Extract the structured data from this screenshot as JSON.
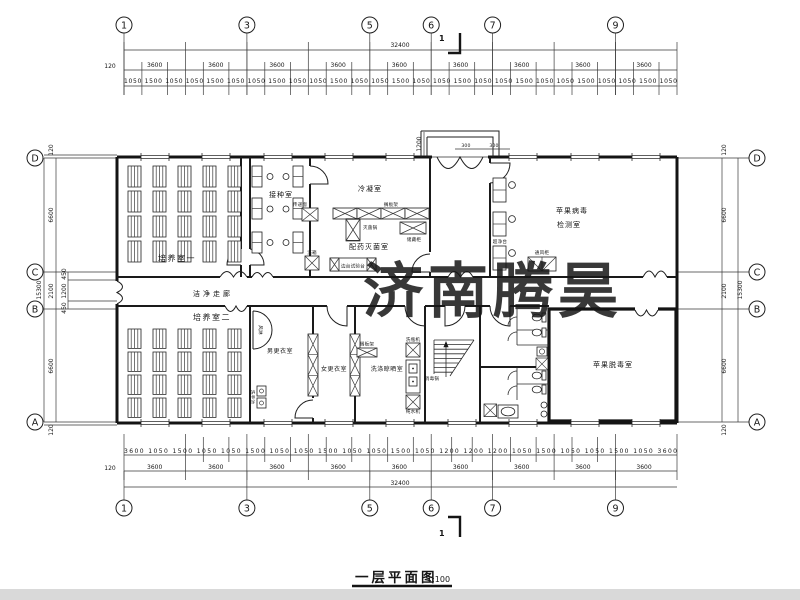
{
  "watermark": {
    "text": "济南腾昊"
  },
  "title": {
    "text": "一层平面图",
    "scale": "1:100"
  },
  "colors": {
    "watermark": "#e8463c",
    "lines": "#1a1a1a",
    "bottom_bar": "#d9d9d9"
  },
  "section_marker": "1",
  "grid": {
    "cols": [
      "1",
      "3",
      "5",
      "6",
      "7",
      "9"
    ],
    "rows": [
      "D",
      "C",
      "B",
      "A"
    ]
  },
  "dims": {
    "overall_h": "32400",
    "overall_v": "15300",
    "edge": "120",
    "top_bays": "3600 3600 3600 3600 3600 3600 3600 3600 3600",
    "top_sub": "1050 1500 1050 1050 1500 1050 1050 1500 1050 1050 1500 1050 1050 1500 1050 1050 1500 1050 1050 1500 1050 1050 1500 1050 1050 1500 1050",
    "bottom_bays": "3600 3600 3600 3600 3600 3600 3600 3600 3600",
    "bottom_sub": "3600 1050 1500 1050 1050 1500 1050 1050 1500 1050 1050 1500 1050 1200 1200 1200 1050 1500 1050 1050 1500 1050 3600",
    "left": {
      "v1": "120",
      "v2": "6600",
      "v3": "2100",
      "v4": "6600",
      "v5": "120",
      "s1": "450",
      "s2": "1200",
      "s3": "450"
    },
    "right": {
      "v1": "120",
      "v2": "6600",
      "v3": "2100",
      "v4": "6600",
      "v5": "120"
    },
    "entrance": {
      "w": "1200",
      "a": "300",
      "b": "300"
    }
  },
  "rooms": {
    "cultivation1": "培养室一",
    "inoculation": "接种室",
    "condensation": "冷凝室",
    "prep_sterilization": "配药灭菌室",
    "detection_line1": "苹果病毒",
    "detection_line2": "检测室",
    "clean_corridor": "洁净走廊",
    "cultivation2": "培养室二",
    "men_changing": "男更衣室",
    "women_changing": "女更衣室",
    "washing_drying": "洗涤晾晒室",
    "detox": "苹果脱毒室"
  },
  "equipment": {
    "pass_window": "传递窗",
    "wash_box": "洗箱",
    "sterilizer_pot": "灭菌锅",
    "shelf_rack": "搁板架",
    "storage_cabinet": "储藏柜",
    "side_test_bench": "边台试验台",
    "clean_bench": "超净台",
    "fume_hood": "通风柜",
    "air_shower": "风淋",
    "hand_wash_sink": "洗手池",
    "shelf_rack2": "搁板架",
    "bottle_washer": "洗瓶机",
    "disinfect_pot": "消毒锅",
    "pure_water_machine": "纯水机"
  }
}
